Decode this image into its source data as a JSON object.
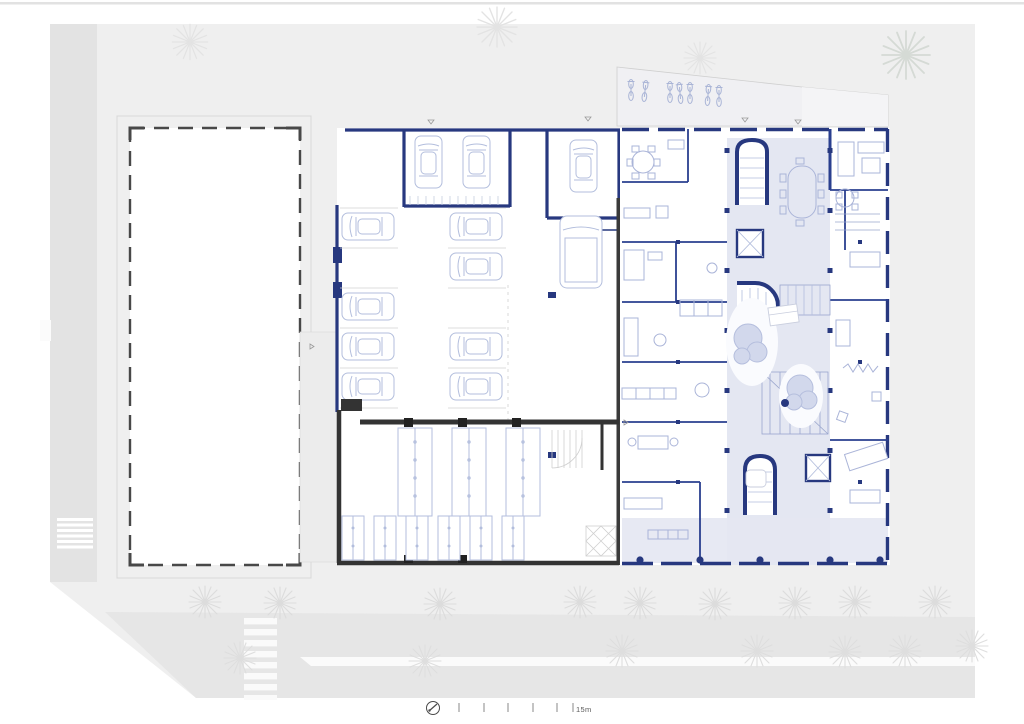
{
  "drawing": {
    "scale_bar": {
      "label": "15m",
      "tick_count": 6
    },
    "icons": {
      "north_arrow": "north-arrow-icon"
    },
    "colors": {
      "wall_navy": "#27387f",
      "wall_dark": "#3a3a3a",
      "existing_building_outline": "#484848",
      "furniture_blue": "#b3bedd",
      "courtyard_fill": "#e4e7f2",
      "site_gray": "#efefef",
      "road_gray": "#e6e6e6",
      "tree_gray": "#dcdcdc"
    },
    "plan_stats": {
      "parked_cars": 11,
      "vans": 1,
      "bicycles": 7,
      "courtyard_trees": 2,
      "crosswalk_stripes": 8
    }
  }
}
